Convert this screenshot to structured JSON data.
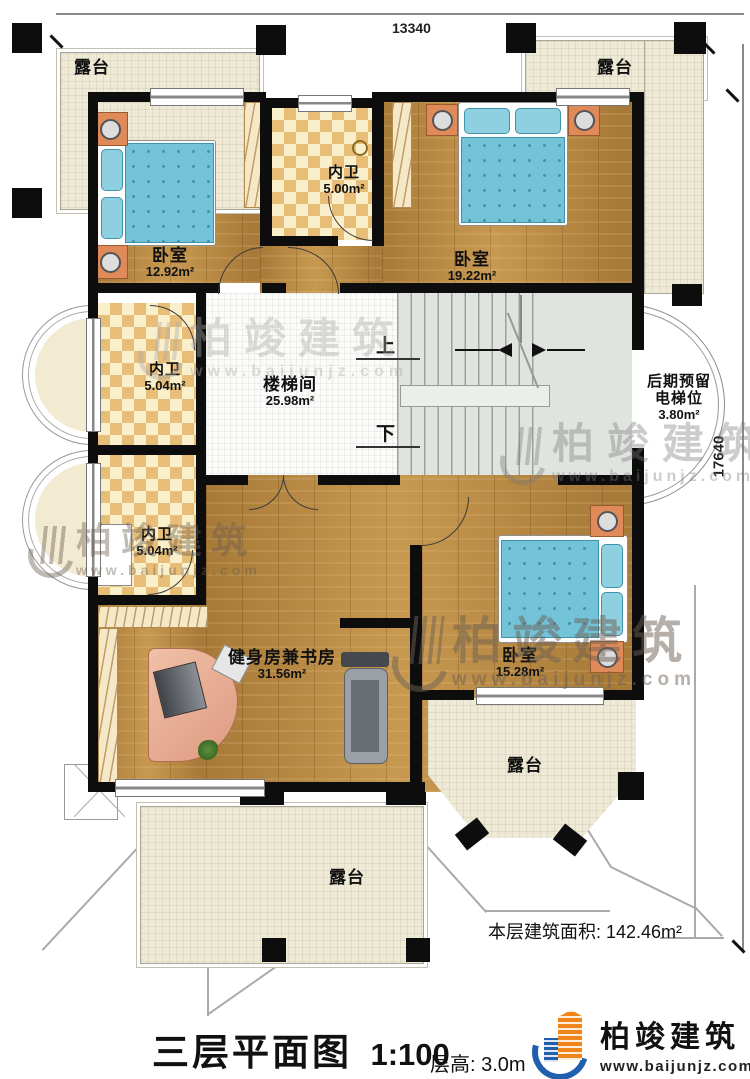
{
  "meta": {
    "title": "三层平面图",
    "scale": "1:100",
    "floor_height": "层高: 3.0m",
    "floor_area": "本层建筑面积: 142.46m²"
  },
  "dimensions": {
    "width": "13340",
    "height": "17640"
  },
  "rooms": {
    "terrace_tl": {
      "name": "露台"
    },
    "terrace_tr": {
      "name": "露台"
    },
    "terrace_br": {
      "name": "露台"
    },
    "terrace_b": {
      "name": "露台"
    },
    "bedroom1": {
      "name": "卧室",
      "area": "12.92m²"
    },
    "bath_top": {
      "name": "内卫",
      "area": "5.00m²"
    },
    "bedroom2": {
      "name": "卧室",
      "area": "19.22m²"
    },
    "bath_mid": {
      "name": "内卫",
      "area": "5.04m²"
    },
    "bath_low": {
      "name": "内卫",
      "area": "5.04m²"
    },
    "stair_hall": {
      "name": "楼梯间",
      "area": "25.98m²"
    },
    "elevator": {
      "line1": "后期预留",
      "line2": "电梯位",
      "area": "3.80m²"
    },
    "gym": {
      "name": "健身房兼书房",
      "area": "31.56m²"
    },
    "bedroom3": {
      "name": "卧室",
      "area": "15.28m²"
    }
  },
  "stairs": {
    "up": "上",
    "down": "下"
  },
  "brand": {
    "name": "柏竣建筑",
    "url": "www.baijunjz.com"
  },
  "colors": {
    "wall": "#0d0d0d",
    "wood": "#b2813d",
    "terrace": "#efead5",
    "tile_a": "#e8bd77",
    "tile_b": "#f9efcb",
    "bed": "#72c2d8",
    "stair": "#e0e4df",
    "logo_blue": "#1f5fae",
    "logo_orange": "#f08519"
  }
}
